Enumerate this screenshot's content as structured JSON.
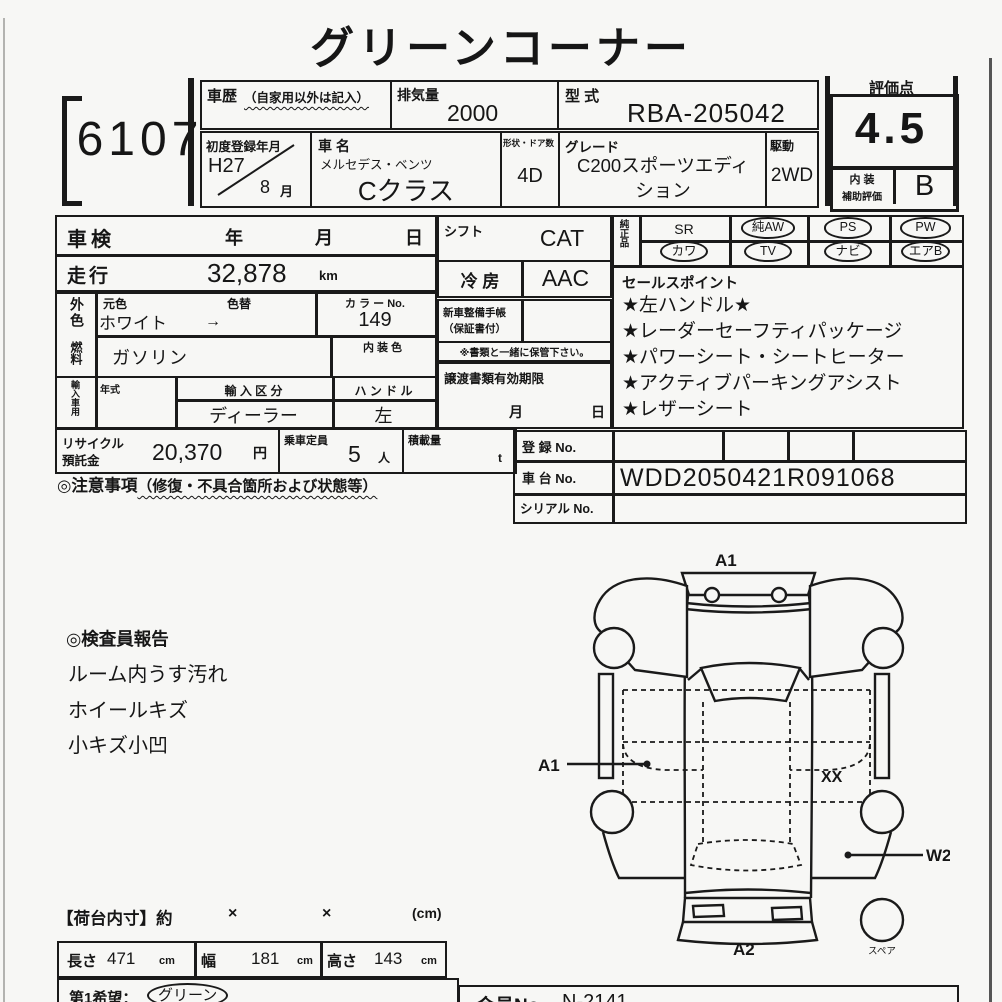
{
  "title": "グリーンコーナー",
  "lot_no": "6107",
  "header": {
    "history_label": "車歴",
    "history_note": "（自家用以外は記入）",
    "displacement_label": "排気量",
    "displacement_value": "2000",
    "model_code_label": "型 式",
    "model_code_value": "RBA-205042",
    "first_reg_label": "初度登録年月",
    "first_reg_year": "H27",
    "first_reg_month": "8",
    "month_suffix": "月",
    "car_name_label": "車 名",
    "car_maker": "メルセデス・ベンツ",
    "car_model": "Cクラス",
    "doors_label": "形状・ドア数",
    "doors_value": "4D",
    "grade_label": "グレード",
    "grade_value": "C200スポーツエディション",
    "drive_label": "駆動",
    "drive_value": "2WD"
  },
  "rating": {
    "label": "評価点",
    "score": "4.5",
    "interior_label_1": "内 装",
    "interior_label_2": "補助評価",
    "interior_grade": "B"
  },
  "spec": {
    "shaken_label": "車検",
    "year": "年",
    "month": "月",
    "day": "日",
    "mileage_label": "走行",
    "mileage_value": "32,878",
    "mileage_unit": "km",
    "ext_color_label": "外色",
    "orig_color_label": "元色",
    "recolor_label": "色替",
    "color_value": "ホワイト",
    "color_arrow": "→",
    "color_no_label": "カ ラ ー No.",
    "color_no_value": "149",
    "fuel_label": "燃料",
    "fuel_value": "ガソリン",
    "interior_color_label": "内 装 色",
    "import_label": "輸入車用",
    "model_year_label": "年式",
    "import_class_label": "輸 入 区 分",
    "import_class_value": "ディーラー",
    "handle_label": "ハ ン ド ル",
    "handle_value": "左"
  },
  "middle": {
    "shift_label": "シフト",
    "shift_value": "CAT",
    "ac_label": "冷 房",
    "ac_value": "AAC",
    "service_book_label_1": "新車整備手帳",
    "service_book_label_2": "（保証書付）",
    "keep_note": "※書類と一緒に保管下さい。",
    "transfer_label": "譲渡書類有効期限",
    "transfer_month": "月",
    "transfer_day": "日"
  },
  "equipment": {
    "label": "純正品",
    "items": [
      {
        "label": "SR",
        "circled": false
      },
      {
        "label": "純AW",
        "circled": true
      },
      {
        "label": "PS",
        "circled": true
      },
      {
        "label": "PW",
        "circled": true
      },
      {
        "label": "カワ",
        "circled": true
      },
      {
        "label": "TV",
        "circled": true
      },
      {
        "label": "ナビ",
        "circled": true
      },
      {
        "label": "エアB",
        "circled": true
      }
    ]
  },
  "sales_points": {
    "label": "セールスポイント",
    "items": [
      "★左ハンドル★",
      "★レーダーセーフティパッケージ",
      "★パワーシート・シートヒーター",
      "★アクティブパーキングアシスト",
      "★レザーシート"
    ]
  },
  "recycle": {
    "label_1": "リサイクル",
    "label_2": "預託金",
    "value": "20,370",
    "unit": "円",
    "capacity_label": "乗車定員",
    "capacity_value": "5",
    "capacity_unit": "人",
    "load_label": "積載量",
    "load_unit": "t"
  },
  "caution": {
    "label": "◎注意事項",
    "note": "（修復・不具合箇所および状態等）"
  },
  "registration": {
    "reg_no_label": "登 録 No.",
    "chassis_label": "車 台 No.",
    "chassis_value": "WDD2050421R091068",
    "serial_label": "シリアル No."
  },
  "inspector_report": {
    "title": "◎検査員報告",
    "items": [
      "ルーム内うす汚れ",
      "ホイールキズ",
      "小キズ小凹"
    ]
  },
  "diagram": {
    "front_label": "A1",
    "left_door_label": "A1",
    "right_panel_label": "XX",
    "rear_right_label": "W2",
    "rear_label": "A2",
    "spare_label": "スペア"
  },
  "cargo": {
    "title": "【荷台内寸】約",
    "times_1": "×",
    "times_2": "×",
    "unit_note": "(cm)",
    "length_label": "長さ",
    "length_value": "471",
    "length_unit": "cm",
    "width_label": "幅",
    "width_value": "181",
    "width_unit": "cm",
    "height_label": "高さ",
    "height_value": "143",
    "height_unit": "cm"
  },
  "footer": {
    "wish_label": "第1希望：",
    "wish_value": "グリーン",
    "member_label": "会員No.",
    "member_value": "N-2141"
  }
}
